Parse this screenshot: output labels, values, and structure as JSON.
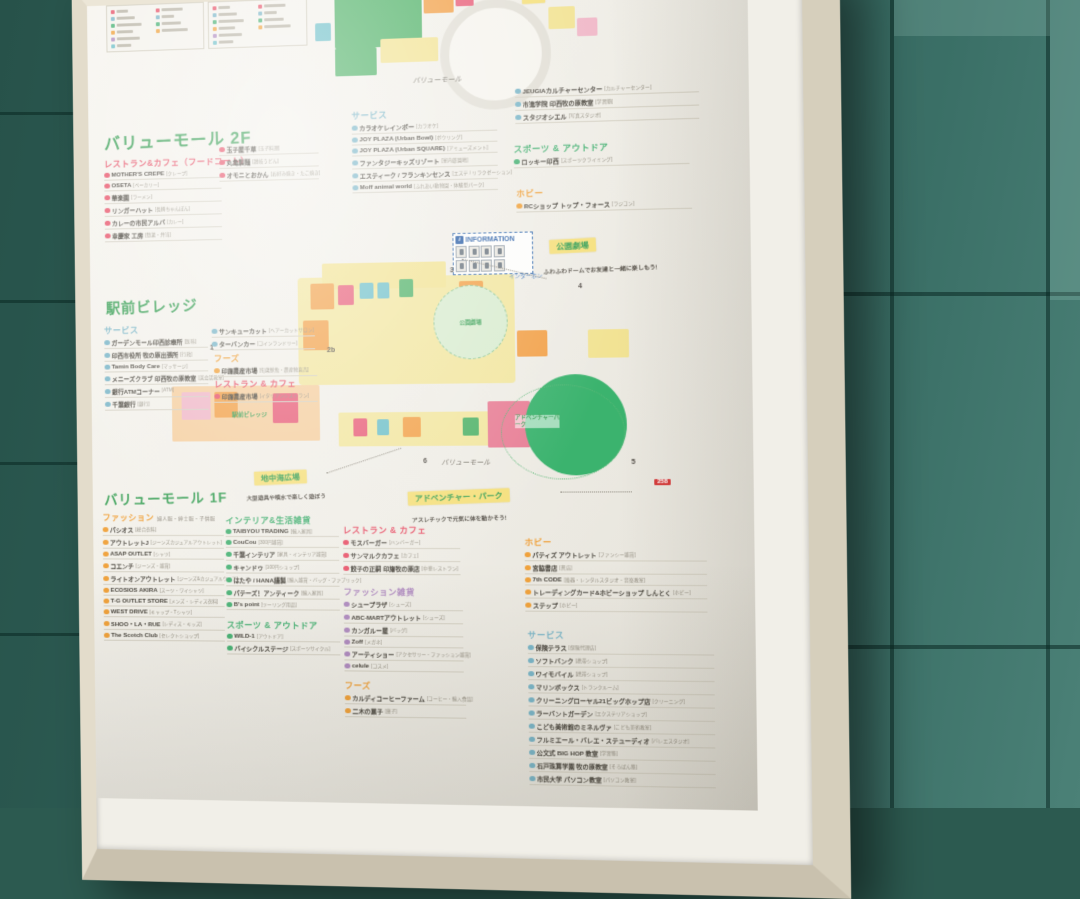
{
  "floors": {
    "vm2f": "バリューモール 2F",
    "ekimae": "駅前ビレッジ",
    "vm1f": "バリューモール 1F"
  },
  "sections": {
    "vm2f_restaurant": {
      "label": "レストラン&カフェ（フードコート）",
      "color": "#e8546a",
      "items": [
        {
          "name": "MOTHER'S CREPE",
          "note": "[クレープ]"
        },
        {
          "name": "OSETA",
          "note": "[ベーカリー]"
        },
        {
          "name": "華楽園",
          "note": "[ラーメン]"
        },
        {
          "name": "リンガーハット",
          "note": "[長崎ちゃんぽん]"
        },
        {
          "name": "カレーの市民アルバ",
          "note": "[カレー]"
        },
        {
          "name": "幸慶家 工房",
          "note": "[惣菜・弁当]"
        }
      ],
      "items2": [
        {
          "name": "玉子屋千草",
          "note": "[玉子料理]"
        },
        {
          "name": "丸亀製麺",
          "note": "[讃岐うどん]"
        },
        {
          "name": "オモニとおかん",
          "note": "[お好み焼き・たこ焼き]"
        }
      ]
    },
    "vm2f_service": {
      "label": "サービス",
      "color": "#7bb6c8",
      "items": [
        {
          "name": "カラオケレインボー",
          "note": "[カラオケ]"
        },
        {
          "name": "JOY PLAZA (Urban Bowl)",
          "note": "[ボウリング]"
        },
        {
          "name": "JOY PLAZA (Urban SQUARE)",
          "note": "[アミューズメント]"
        },
        {
          "name": "ファンタジーキッズリゾート",
          "note": "[室内遊園地]"
        },
        {
          "name": "エスティーク / フランキンセンス",
          "note": "[エステ / リラクゼーション]"
        },
        {
          "name": "Moff animal world",
          "note": "[ふれあい動物園・体験型パーク]"
        }
      ]
    },
    "vm2f_culture": {
      "label": "",
      "color": "#7bb6c8",
      "items": [
        {
          "name": "JEUGIAカルチャーセンター",
          "note": "[カルチャーセンター]"
        },
        {
          "name": "市進学院 印西牧の原教室",
          "note": "[学習塾]"
        },
        {
          "name": "スタジオシエル",
          "note": "[写真スタジオ]"
        }
      ]
    },
    "vm2f_sports": {
      "label": "スポーツ & アウトドア",
      "color": "#49b275",
      "items": [
        {
          "name": "ロッキー印西",
          "note": "[スポーツクライミング]"
        }
      ]
    },
    "vm2f_hobby": {
      "label": "ホビー",
      "color": "#f0a23c",
      "items": [
        {
          "name": "RCショップ トップ・フォース",
          "note": "[ラジコン]"
        }
      ]
    },
    "ekimae_service": {
      "label": "サービス",
      "color": "#7bb6c8",
      "items": [
        {
          "name": "ガーデンモール印西診療所",
          "note": "[医科]"
        },
        {
          "name": "印西市役所 牧の原出張所",
          "note": "[行政]"
        },
        {
          "name": "Tamin Body Care",
          "note": "[マッサージ]"
        },
        {
          "name": "メニーズクラブ 印西牧の原教室",
          "note": "[英会話教室]"
        },
        {
          "name": "銀行ATMコーナー",
          "note": "[ATM]"
        },
        {
          "name": "千葉銀行",
          "note": "[銀行]"
        }
      ],
      "items2": [
        {
          "name": "サンキューカット",
          "note": "[ヘアーカットサロン]"
        },
        {
          "name": "ターバンカー",
          "note": "[コインランドリー]"
        }
      ]
    },
    "ekimae_foods": {
      "label": "フーズ",
      "color": "#f0a23c",
      "items": [
        {
          "name": "印旛農産市場",
          "note": "[旬菜鮮魚・農産物直売]"
        }
      ]
    },
    "ekimae_restaurant": {
      "label": "レストラン & カフェ",
      "color": "#e8546a",
      "items": [
        {
          "name": "印旛農産市場",
          "note": "[イタリアンレストラン]"
        }
      ]
    },
    "vm1f_fashion": {
      "label": "ファッション",
      "sub": "婦人服・紳士服・子供服",
      "color": "#f0a23c",
      "items": [
        {
          "name": "パシオス",
          "note": "[総合衣料]"
        },
        {
          "name": "アウトレットJ",
          "note": "[ジーンズカジュアルアウトレット]"
        },
        {
          "name": "ASAP OUTLET",
          "note": "[シャツ]"
        },
        {
          "name": "コエンチ",
          "note": "[ジーンズ・雑貨]"
        },
        {
          "name": "ライトオンアウトレット",
          "note": "[ジーンズ&カジュアルウェア]"
        },
        {
          "name": "ECOSIOS AKIRA",
          "note": "[スーツ・ワイシャツ]"
        },
        {
          "name": "T-G OUTLET STORE",
          "note": "[メンズ・レディス衣料]"
        },
        {
          "name": "WEST DRIVE",
          "note": "[キャップ・Tシャツ]"
        },
        {
          "name": "SHOO・LA・RUE",
          "note": "[レディス・キッズ]"
        },
        {
          "name": "The Scotch Club",
          "note": "[セレクトショップ]"
        }
      ]
    },
    "vm1f_interior": {
      "label": "インテリア&生活雑貨",
      "color": "#49b275",
      "items": [
        {
          "name": "TAIBYOU TRADING",
          "note": "[輸入家具]"
        },
        {
          "name": "CouCou",
          "note": "[300円雑貨]"
        },
        {
          "name": "千葉インテリア",
          "note": "[家具・インテリア雑貨]"
        },
        {
          "name": "キャンドゥ",
          "note": "[100円ショップ]"
        },
        {
          "name": "はたや / HANA謹製",
          "note": "[輸入雑貨・バッグ・ファブリック]"
        },
        {
          "name": "パテーズ！アンティーク",
          "note": "[輸入家具]"
        },
        {
          "name": "B's point",
          "note": "[ツーリング用品]"
        }
      ]
    },
    "vm1f_sports": {
      "label": "スポーツ & アウトドア",
      "color": "#49b275",
      "items": [
        {
          "name": "WILD-1",
          "note": "[アウトドア]"
        },
        {
          "name": "バイシクルステージ",
          "note": "[スポーツサイクル]"
        }
      ]
    },
    "vm1f_restaurant": {
      "label": "レストラン & カフェ",
      "color": "#e8546a",
      "items": [
        {
          "name": "モスバーガー",
          "note": "[ハンバーガー]"
        },
        {
          "name": "サンマルクカフェ",
          "note": "[カフェ]"
        },
        {
          "name": "餃子の正嗣 印旛牧の原店",
          "note": "[中華レストラン]"
        }
      ]
    },
    "vm1f_fashion_goods": {
      "label": "ファッション雑貨",
      "color": "#b08cc0",
      "items": [
        {
          "name": "シュープラザ",
          "note": "[シューズ]"
        },
        {
          "name": "ABC-MARTアウトレット",
          "note": "[シューズ]"
        },
        {
          "name": "カンガルー屋",
          "note": "[バッグ]"
        },
        {
          "name": "Zoff",
          "note": "[メガネ]"
        },
        {
          "name": "アーティショー",
          "note": "[アクセサリー・ファッション雑貨]"
        },
        {
          "name": "celule",
          "note": "[コスメ]"
        }
      ]
    },
    "vm1f_foods": {
      "label": "フーズ",
      "color": "#f0a23c",
      "items": [
        {
          "name": "カルディコーヒーファーム",
          "note": "[コーヒー・輸入食品]"
        },
        {
          "name": "二木の菓子",
          "note": "[菓子]"
        }
      ]
    },
    "vm1f_hobby": {
      "label": "ホビー",
      "color": "#f0a23c",
      "items": [
        {
          "name": "パティズ アウトレット",
          "note": "[ファンシー雑貨]"
        },
        {
          "name": "宮脇書店",
          "note": "[書店]"
        },
        {
          "name": "7th CODE",
          "note": "[楽器・レンタルスタジオ・音楽教室]"
        },
        {
          "name": "トレーディングカード&ホビーショップ しんとく",
          "note": "[ホビー]"
        },
        {
          "name": "ステップ",
          "note": "[ホビー]"
        }
      ]
    },
    "vm1f_service": {
      "label": "サービス",
      "color": "#7bb6c8",
      "items": [
        {
          "name": "保険テラス",
          "note": "[保険代理店]"
        },
        {
          "name": "ソフトバンク",
          "note": "[携帯ショップ]"
        },
        {
          "name": "ワイモバイル",
          "note": "[携帯ショップ]"
        },
        {
          "name": "マリンボックス",
          "note": "[トランクルーム]"
        },
        {
          "name": "クリーニングローヤル21ビッグホップ店",
          "note": "[クリーニング]"
        },
        {
          "name": "ラーバントガーデン",
          "note": "[エクステリアショップ]"
        },
        {
          "name": "こども美術館のミネルヴァ",
          "note": "[こども美術教室]"
        },
        {
          "name": "フルミエール・バレエ・ステューディオ",
          "note": "[バレエスタジオ]"
        },
        {
          "name": "公文式 BIG HOP 教室",
          "note": "[学習塾]"
        },
        {
          "name": "石戸珠算学園 牧の原教室",
          "note": "[そろばん塾]"
        },
        {
          "name": "市民大学 パソコン教室",
          "note": "[パソコン教室]"
        }
      ]
    }
  },
  "map": {
    "information": "INFORMATION",
    "park_theater": {
      "label": "公園劇場",
      "caption": "ふわふわドームでお友達と一緒に楽しもう!"
    },
    "park_theater_area": "公園劇場",
    "mediterranean_plaza": {
      "label": "地中海広場",
      "caption": "大型遊具や噴水で楽しく遊ぼう"
    },
    "adventure_park": {
      "label": "アドベンチャー・パーク",
      "caption": "アスレチックで元気に体を動かそう!"
    },
    "adventure_area": "アドベンチャーパーク",
    "value_mall_top": "バリューモール",
    "value_mall_bottom": "バリューモール",
    "ekimae_area": "駅前ビレッジ",
    "intercom": "インターホン",
    "road_badge": "258",
    "markers": [
      "1",
      "2b",
      "3",
      "4",
      "5",
      "6"
    ]
  }
}
